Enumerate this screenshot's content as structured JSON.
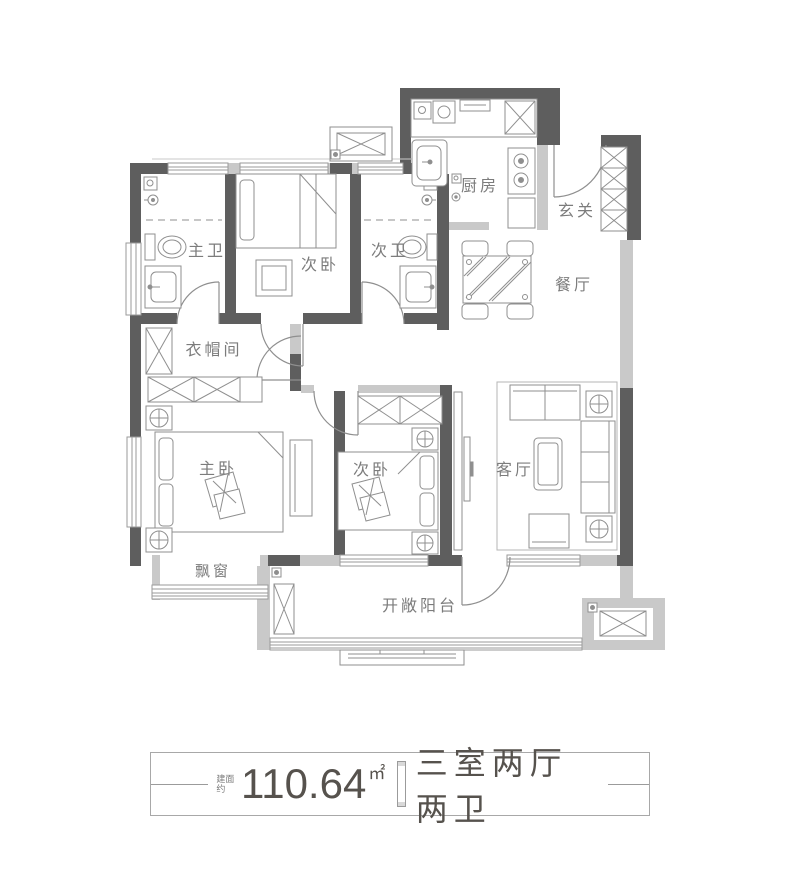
{
  "colors": {
    "wall_dark": "#5e5e5e",
    "wall_light": "#c9c9c9",
    "furniture_line": "#8f8f8f",
    "label_text": "#7c7c7c",
    "caption_text": "#56524d",
    "background": "#ffffff"
  },
  "rooms": [
    {
      "id": "master-bath",
      "label": "主卫"
    },
    {
      "id": "bedroom-top",
      "label": "次卧"
    },
    {
      "id": "second-bath",
      "label": "次卫"
    },
    {
      "id": "kitchen",
      "label": "厨房"
    },
    {
      "id": "foyer",
      "label": "玄关"
    },
    {
      "id": "dining",
      "label": "餐厅"
    },
    {
      "id": "cloakroom",
      "label": "衣帽间"
    },
    {
      "id": "master-bedroom",
      "label": "主卧"
    },
    {
      "id": "bedroom-bottom",
      "label": "次卧"
    },
    {
      "id": "living",
      "label": "客厅"
    },
    {
      "id": "bay-window",
      "label": "飘窗"
    },
    {
      "id": "balcony",
      "label": "开敞阳台"
    }
  ],
  "caption": {
    "area_prefix": "建面约",
    "area_value": "110.64",
    "area_unit": "㎡",
    "layout_text": "三室两厅两卫"
  }
}
